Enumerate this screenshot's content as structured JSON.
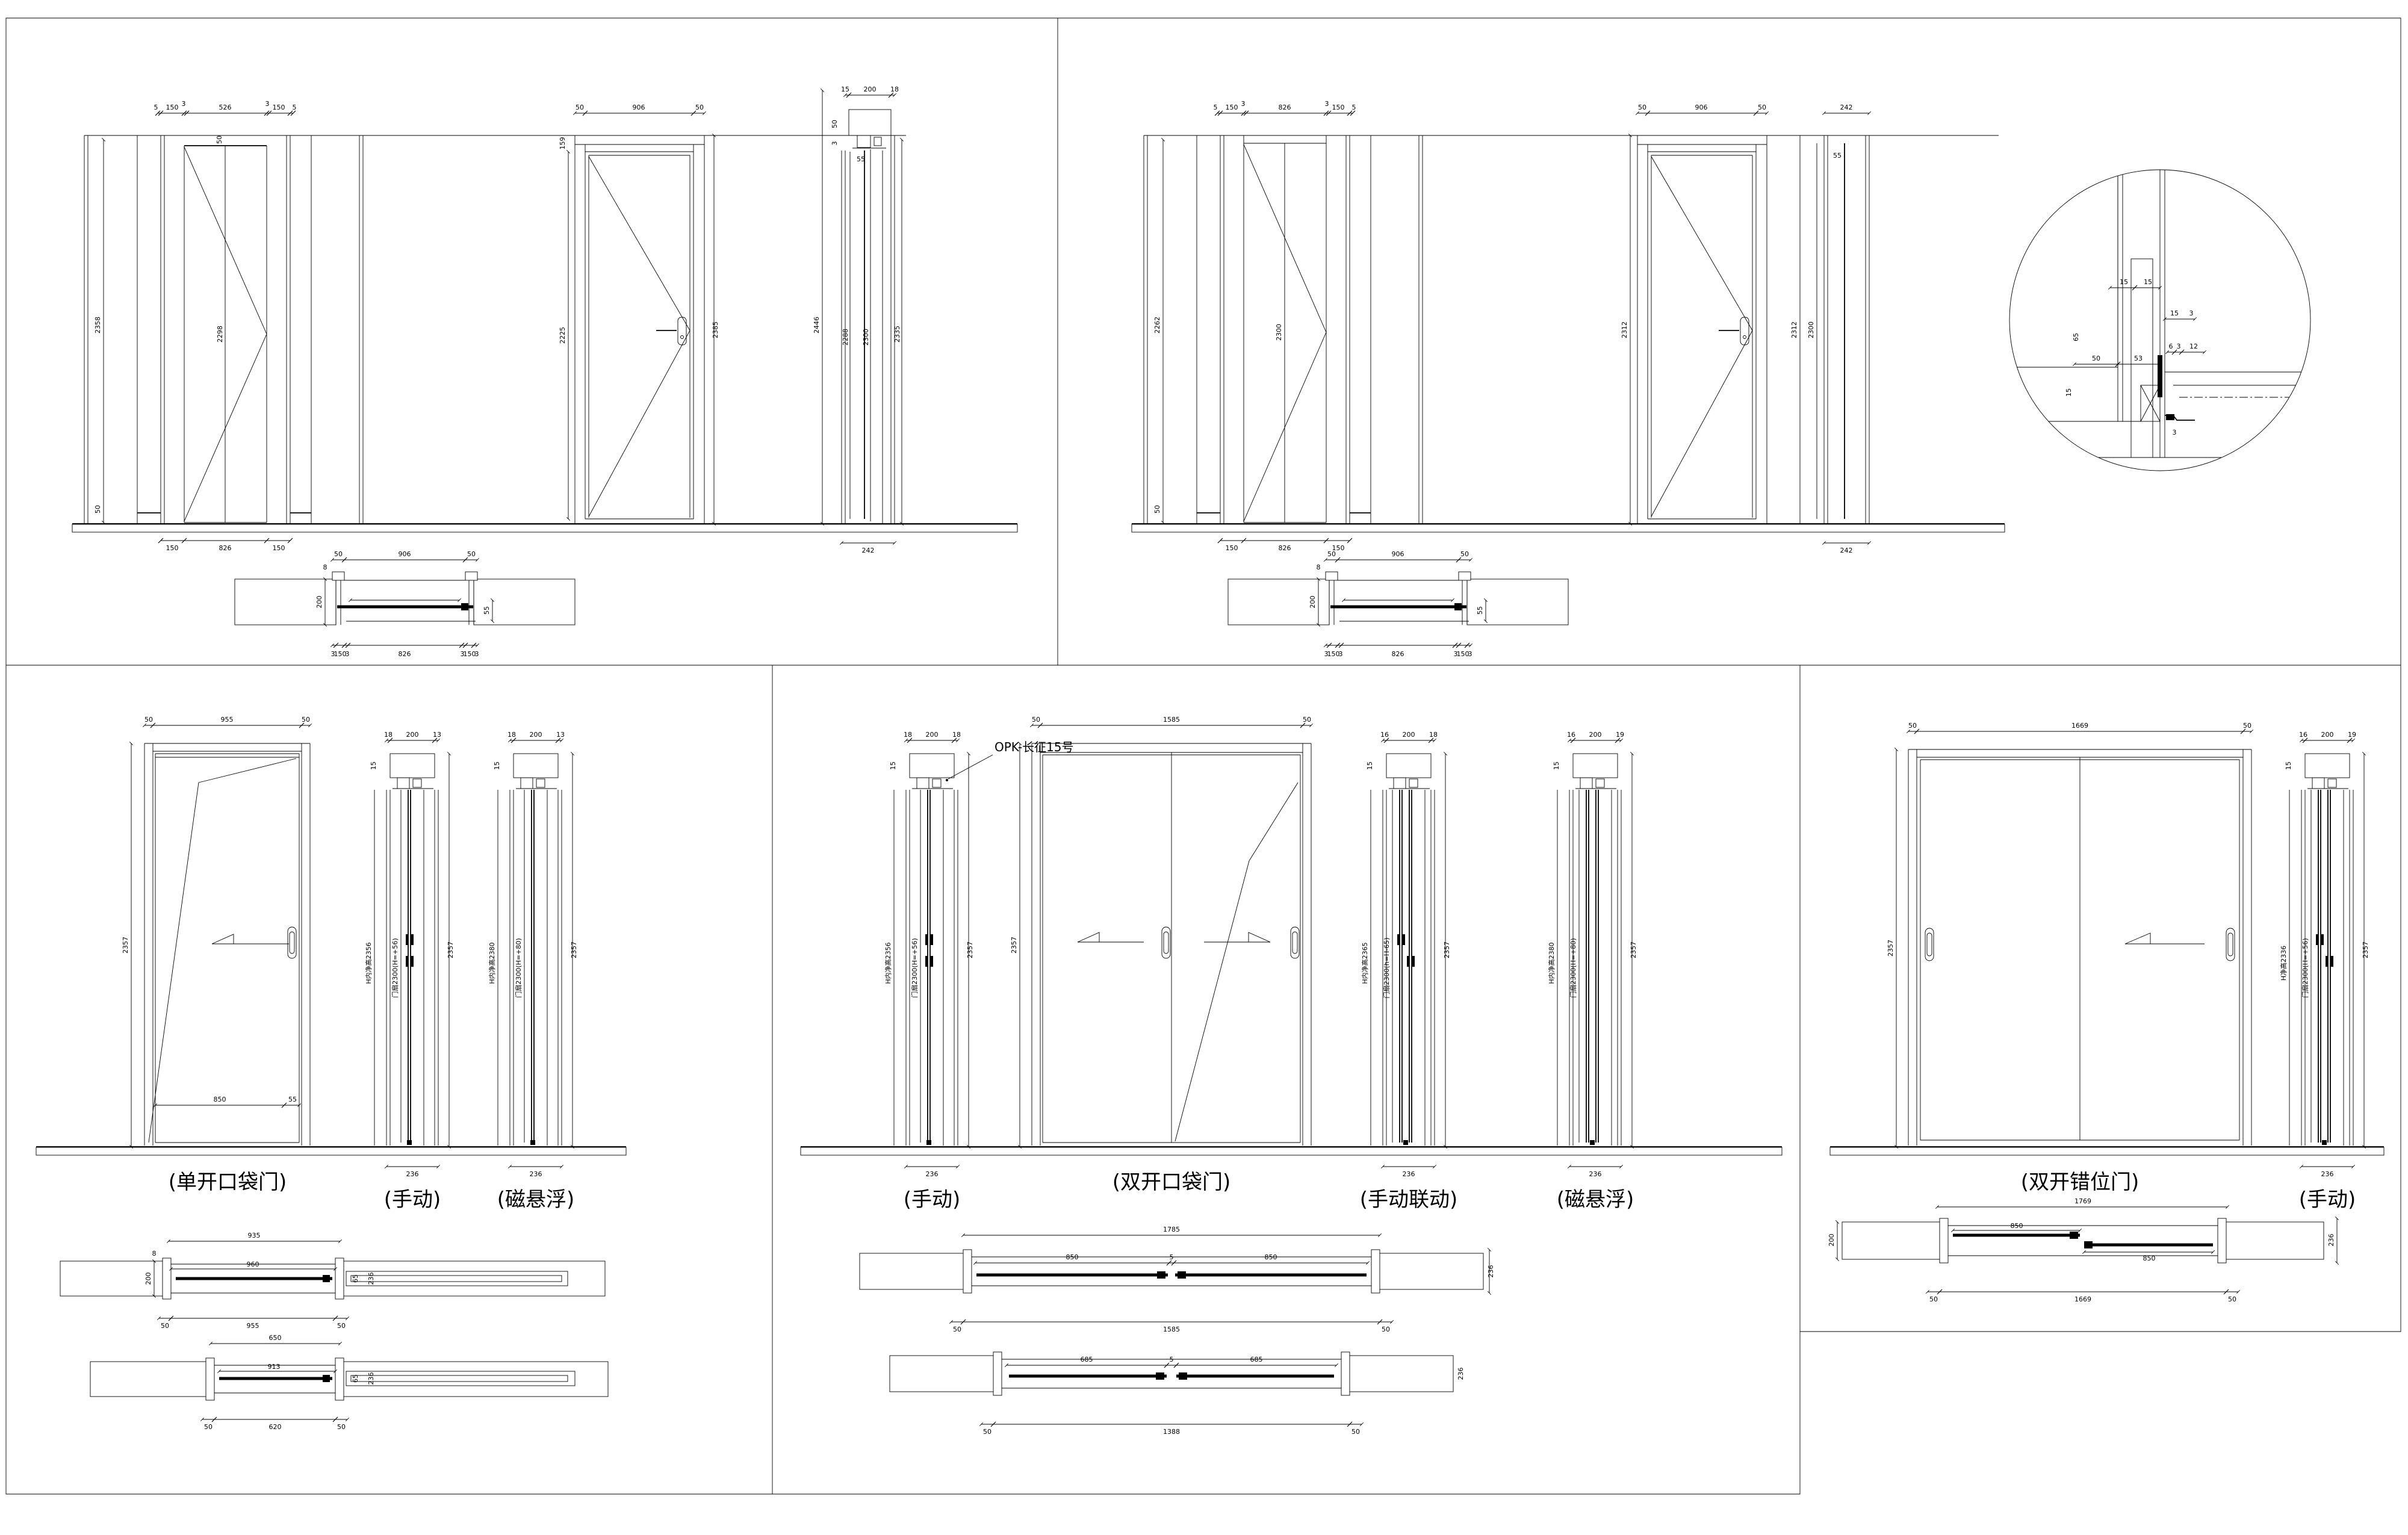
{
  "tl": {
    "e1": {
      "top": [
        "5",
        "150",
        "3",
        "526",
        "3",
        "150",
        "5"
      ],
      "hdr": "50",
      "ht": "2358",
      "hb": "50",
      "hd": "2298",
      "bot": [
        "150",
        "826",
        "150"
      ]
    },
    "e2": {
      "top": [
        "50",
        "906",
        "50"
      ],
      "t159": "159",
      "hd": "2225",
      "ht": "2385"
    },
    "s": {
      "top": [
        "15",
        "200",
        "18"
      ],
      "a": "50",
      "b": "3",
      "c": "55",
      "h": [
        "2446",
        "2288",
        "2300",
        "2335"
      ],
      "bot": "242"
    },
    "p": {
      "top": [
        "50",
        "906",
        "50"
      ],
      "bot": [
        "3",
        "150",
        "3",
        "826",
        "3",
        "150",
        "3"
      ],
      "w": "200",
      "w8": "8",
      "g": "55"
    }
  },
  "tr": {
    "e1": {
      "top": [
        "5",
        "150",
        "3",
        "826",
        "3",
        "150",
        "5"
      ],
      "ht": "2262",
      "hb": "50",
      "hd": "2300",
      "bot": [
        "150",
        "826",
        "150"
      ]
    },
    "e2": {
      "top": [
        "50",
        "906",
        "50"
      ],
      "hd": "2312"
    },
    "s": {
      "t": "242",
      "g": "55",
      "h": [
        "2312",
        "2300"
      ],
      "bot": "242"
    },
    "d": {
      "t": [
        "15",
        "15",
        "15",
        "3",
        "50",
        "53",
        "6",
        "3",
        "12",
        "65",
        "15",
        "3"
      ]
    },
    "p": {
      "top": [
        "50",
        "906",
        "50"
      ],
      "bot": [
        "3",
        "150",
        "3",
        "826",
        "3",
        "150",
        "3"
      ],
      "w": "200",
      "w8": "8",
      "g": "55"
    }
  },
  "bl": {
    "e": {
      "top": [
        "50",
        "955",
        "50"
      ],
      "h": "2357",
      "b1": "850",
      "b2": "55",
      "label": "(单开口袋门)"
    },
    "s1": {
      "top": [
        "18",
        "200",
        "13"
      ],
      "g": "15",
      "ht": "H内净高2356",
      "lf": "门扇2300(H=+56)",
      "h": "2357",
      "bot": "236",
      "label": "(手动)"
    },
    "s2": {
      "top": [
        "18",
        "200",
        "13"
      ],
      "g": "15",
      "ht": "H内净高2380",
      "lf": "门扇2300(H=+80)",
      "h": "2357",
      "bot": "236",
      "label": "(磁悬浮)"
    },
    "p1": {
      "top": "935",
      "in": "960",
      "bot": [
        "50",
        "955",
        "50"
      ],
      "w": "200",
      "w8": "8",
      "g1": "65",
      "g2": "236"
    },
    "p2": {
      "top": "650",
      "in": "913",
      "bot": [
        "50",
        "620",
        "50"
      ],
      "g1": "65",
      "g2": "236"
    }
  },
  "bm": {
    "callout": "OPK-长征15号",
    "s0": {
      "top": [
        "18",
        "200",
        "18"
      ],
      "g": "15",
      "ht": "H内净高2356",
      "lf": "门扇2300(H=+56)",
      "h": "2357",
      "bot": "236",
      "label": "(手动)"
    },
    "e": {
      "top": [
        "50",
        "1585",
        "50"
      ],
      "h": "2357",
      "label": "(双开口袋门)"
    },
    "s1": {
      "top": [
        "16",
        "200",
        "18"
      ],
      "g": "15",
      "ht": "H内净高2365",
      "lf": "门扇2300(h=H-65)",
      "h": "2357",
      "bot": "236",
      "label": "(手动联动)"
    },
    "s2": {
      "top": [
        "16",
        "200",
        "19"
      ],
      "g": "15",
      "ht": "H内净高2380",
      "lf": "门扇2300(H=+80)",
      "h": "2357",
      "bot": "236",
      "label": "(磁悬浮)"
    },
    "p1": {
      "top": "1785",
      "in": [
        "850",
        "5",
        "850"
      ],
      "bot": [
        "50",
        "1585",
        "50"
      ],
      "w": "200",
      "g": "236"
    },
    "p2": {
      "in": [
        "685",
        "5",
        "685"
      ],
      "bot": [
        "50",
        "1388",
        "50"
      ],
      "g": "236"
    }
  },
  "br": {
    "e": {
      "top": [
        "50",
        "1669",
        "50"
      ],
      "h": "2357",
      "label": "(双开错位门)"
    },
    "s": {
      "top": [
        "16",
        "200",
        "19"
      ],
      "g": "15",
      "ht": "H净高2336",
      "lf": "门扇2300(H=+56)",
      "h": "2357",
      "bot": "236",
      "label": "(手动)"
    },
    "p": {
      "top": "1769",
      "i1": "850",
      "i2": "850",
      "bot": [
        "50",
        "1669",
        "50"
      ],
      "w": "200",
      "g": "236"
    }
  }
}
